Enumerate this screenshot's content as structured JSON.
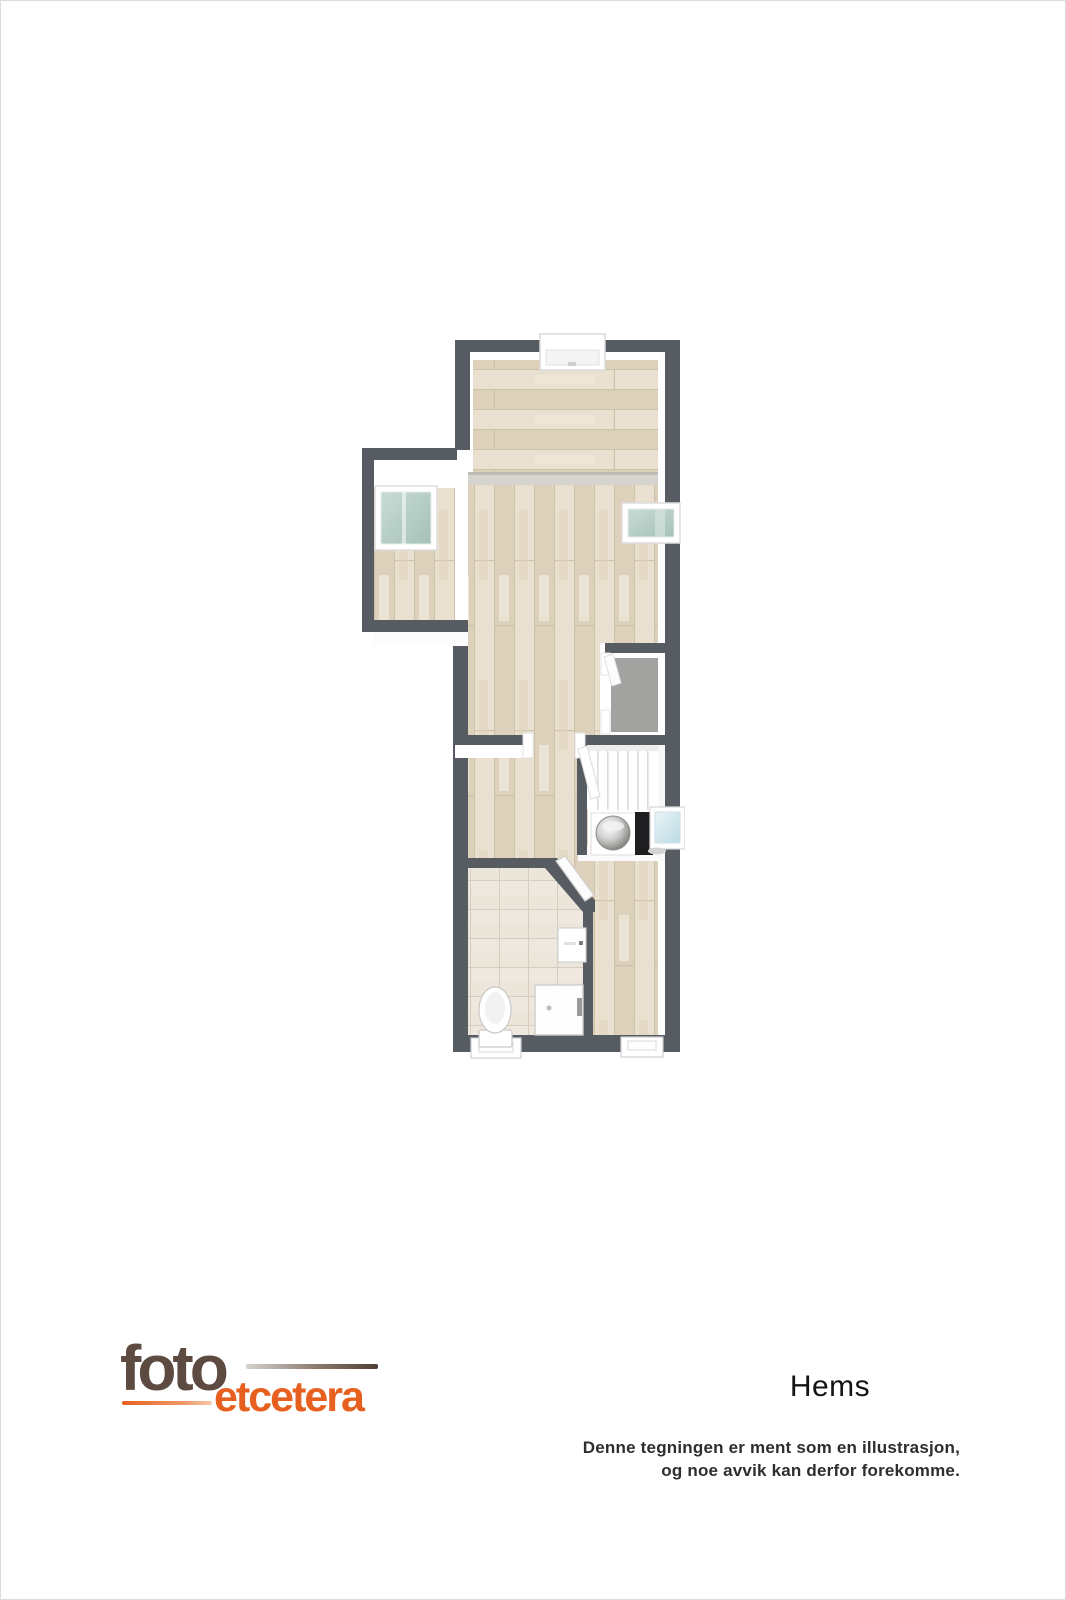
{
  "branding": {
    "logo_text_primary": "foto",
    "logo_text_secondary": "etcetera",
    "logo_color_primary": "#5d4a40",
    "logo_color_secondary": "#e7601f"
  },
  "plan": {
    "title": "Hems",
    "disclaimer_line1": "Denne tegningen er ment som en illustrasjon,",
    "disclaimer_line2": "og noe avvik kan derfor forekomme.",
    "colors": {
      "wall": "#575c62",
      "inner_white": "#ffffff",
      "floor_wood": "#e3d9c6",
      "floor_wood_light": "#e9e0cf",
      "floor_wood_dark": "#ddd1bc",
      "wood_seam": "#cfc2ab",
      "beam": "#d6d4ce",
      "beam_edge": "#bdbbb5",
      "floor_tile": "#ece5da",
      "tile_grid": "#d6ccbf",
      "carpet": "#a2a2a0",
      "glass_frame": "#ffffff",
      "stair_line": "#dcdcdc",
      "appliance_dark": "#1e1e20",
      "basin_blue": "#cfe4ea",
      "fixture_outline": "#c9c9c9"
    },
    "elements": [
      "dormer-window-top",
      "roof-window-left",
      "roof-window-right",
      "storage-room-carpet",
      "staircase",
      "stair-railing",
      "water-heater",
      "dark-appliance",
      "under-stair-sink",
      "bathroom-door",
      "wall-cabinet",
      "shower-unit",
      "toilet",
      "bottom-window-left",
      "bottom-window-right"
    ]
  }
}
